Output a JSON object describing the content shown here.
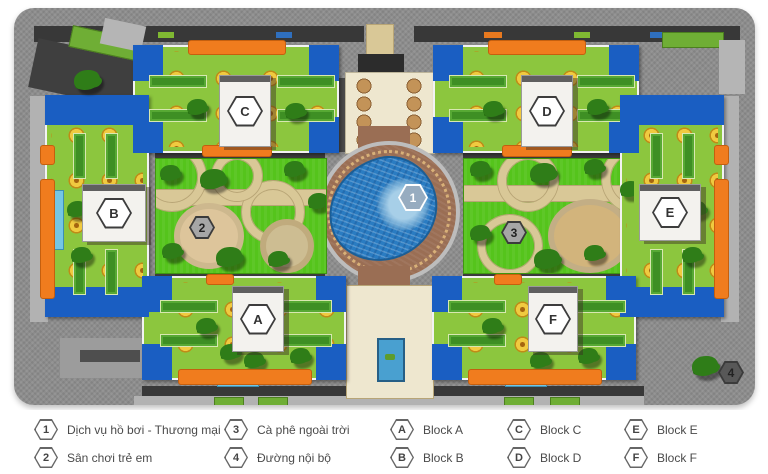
{
  "plan": {
    "markers": {
      "pool": "1",
      "playground": "2",
      "cafe": "3",
      "road": "4"
    },
    "blocks": {
      "a": "A",
      "b": "B",
      "c": "C",
      "d": "D",
      "e": "E",
      "f": "F"
    },
    "colors": {
      "roof_green": "#8cc63e",
      "accent_blue": "#1a5ec2",
      "accent_orange": "#f07c1e",
      "grass": "#55c41c",
      "pool_water": "#2a7cc2",
      "deck_brown": "#9a6e54",
      "path_tan": "#d9c897",
      "road_gray": "#8d8d8d"
    }
  },
  "legend": {
    "items": [
      {
        "num": "1",
        "label": "Dịch vụ hồ bơi - Thương mại"
      },
      {
        "num": "2",
        "label": "Sân chơi trẻ em"
      },
      {
        "num": "3",
        "label": "Cà phê ngoài trời"
      },
      {
        "num": "4",
        "label": "Đường nội bộ"
      }
    ],
    "blocks": [
      {
        "key": "A",
        "label": "Block A"
      },
      {
        "key": "B",
        "label": "Block B"
      },
      {
        "key": "C",
        "label": "Block C"
      },
      {
        "key": "D",
        "label": "Block D"
      },
      {
        "key": "E",
        "label": "Block E"
      },
      {
        "key": "F",
        "label": "Block F"
      }
    ]
  }
}
